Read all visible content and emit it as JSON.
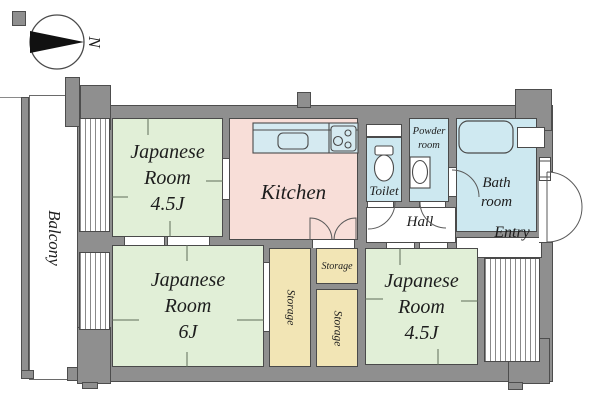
{
  "compass": {
    "label": "N"
  },
  "balcony": {
    "label": "Balcony"
  },
  "rooms": {
    "japanese_room_top": {
      "lines": [
        "Japanese",
        "Room",
        "4.5J"
      ]
    },
    "kitchen": {
      "label": "Kitchen"
    },
    "toilet": {
      "label": "Toilet"
    },
    "powder_room": {
      "lines": [
        "Powder",
        "room"
      ]
    },
    "bath_room": {
      "lines": [
        "Bath",
        "room"
      ]
    },
    "hall": {
      "label": "Hall"
    },
    "entry": {
      "label": "Entry"
    },
    "japanese_room_6j": {
      "lines": [
        "Japanese",
        "Room",
        "6J"
      ]
    },
    "japanese_room_bottom": {
      "lines": [
        "Japanese",
        "Room",
        "4.5J"
      ]
    },
    "storage_left": {
      "label": "Storage"
    },
    "storage_top": {
      "label": "Storage"
    },
    "storage_bottom": {
      "label": "Storage"
    }
  },
  "fixtures": {
    "compass_north_arrow": "north-arrow",
    "toilet_bowl": "toilet-icon",
    "bathtub": "bathtub-icon",
    "kitchen_sink": "kitchen-sink-icon",
    "stove": "stove-burners-icon",
    "washbasin": "washbasin-icon"
  },
  "colors": {
    "wall": "#8f8f8f",
    "wall_outline": "#4d4d4d",
    "japanese_room": "#e1efd7",
    "kitchen": "#f8ded8",
    "wet_area": "#cde8f0",
    "storage": "#f2e5b5",
    "text": "#1d1d1d",
    "background": "#ffffff"
  }
}
